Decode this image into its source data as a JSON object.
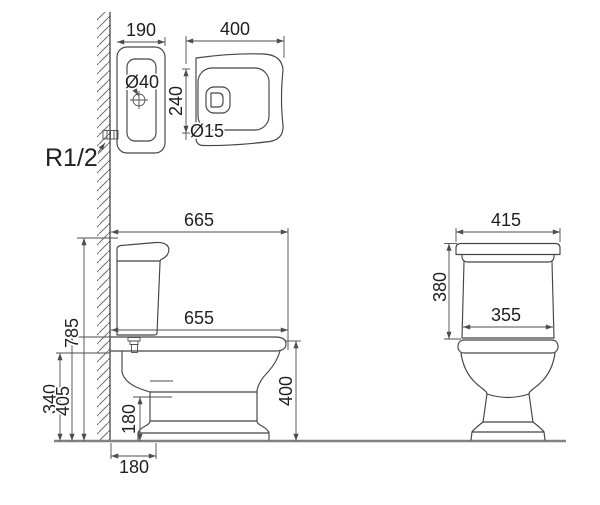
{
  "views": {
    "plan": {
      "label_tank_depth": "190",
      "label_bowl_length": "400",
      "label_lid_hole": "Ø40",
      "label_hole_spacing": "240",
      "label_fixing_hole": "Ø15",
      "label_water_inlet": "R1/2"
    },
    "side": {
      "label_overall_depth": "665",
      "label_bowl_depth": "655",
      "label_total_height": "785",
      "label_inlet_height": "340",
      "label_tank_base_height": "405",
      "label_outlet_height": "180",
      "label_outlet_offset": "180",
      "label_rim_height": "400"
    },
    "front": {
      "label_tank_width": "415",
      "label_tank_height": "380",
      "label_base_width": "355"
    }
  },
  "style": {
    "line_color": "#454545",
    "floor_color": "#828282",
    "background": "#ffffff"
  }
}
